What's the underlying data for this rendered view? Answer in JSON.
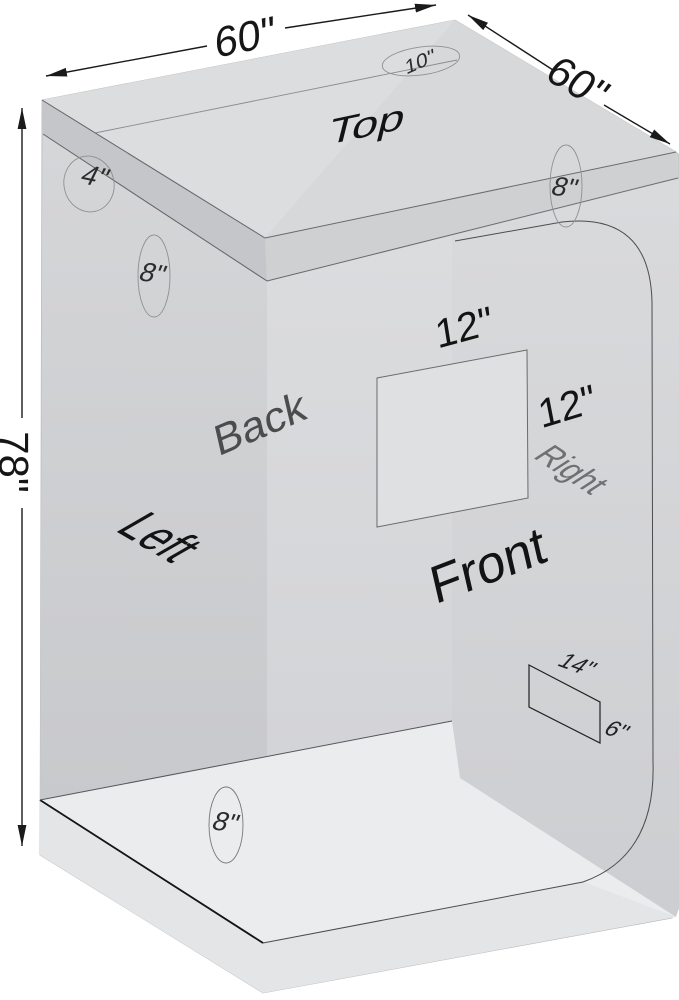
{
  "dimensions": {
    "width": "60\"",
    "depth": "60\"",
    "height": "78\""
  },
  "faces": {
    "top": "Top",
    "back": "Back",
    "left": "Left",
    "front": "Front",
    "right": "Right"
  },
  "ports": {
    "top": "10\"",
    "left_upper": "4\"",
    "left": "8\"",
    "right": "8\"",
    "bottom": "8\""
  },
  "window": {
    "width": "12\"",
    "height": "12\""
  },
  "vent": {
    "width": "14\"",
    "height": "6\""
  },
  "colors": {
    "background": "#ffffff",
    "line": "#1a1a1a",
    "panel_top": "#dcddde",
    "panel_side": "#d2d3d5",
    "floor": "#ebeced"
  }
}
